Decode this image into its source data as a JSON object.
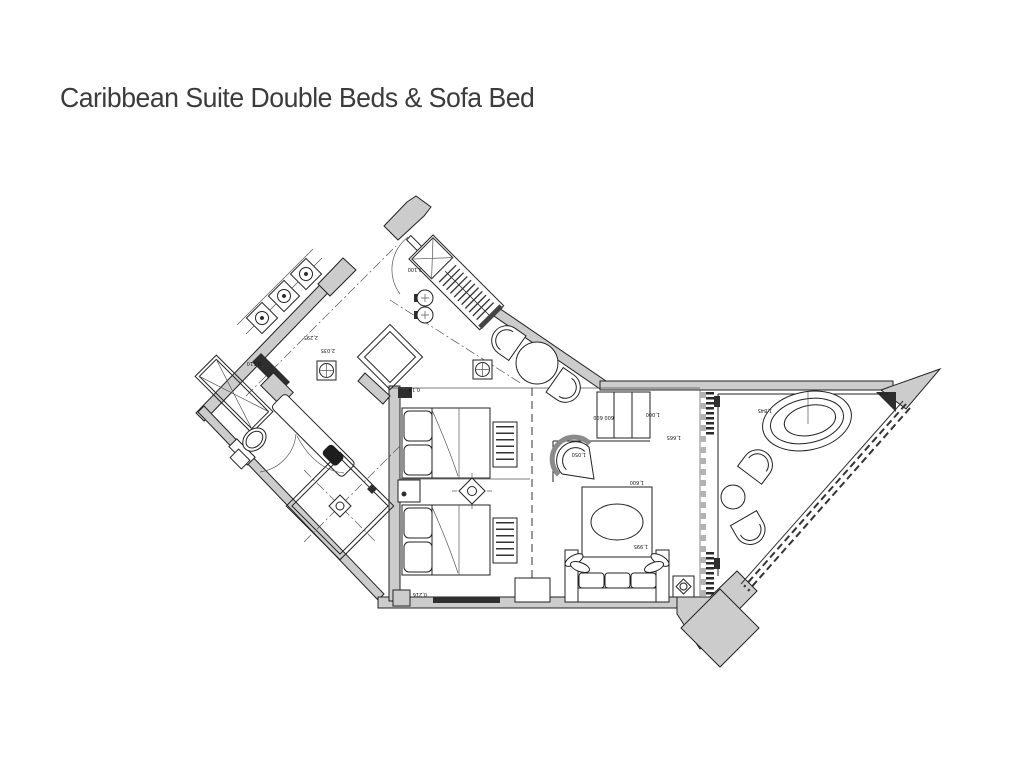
{
  "page": {
    "title": "Caribbean Suite Double Beds & Sofa Bed"
  },
  "colors": {
    "background": "#ffffff",
    "line": "#222222",
    "wall_fill": "#cccccc",
    "wall_dark": "#2e2e2e",
    "title_text": "#3c3c3c",
    "dash_gray": "#b3b3b3",
    "thin": "#555555"
  },
  "plan": {
    "dims": [
      {
        "text": "2,100"
      },
      {
        "text": "2,295"
      },
      {
        "text": "2,035"
      },
      {
        "text": "0,510"
      },
      {
        "text": "0,19"
      },
      {
        "text": "0,216"
      },
      {
        "text": "600 600"
      },
      {
        "text": "1,000"
      },
      {
        "text": "1,665"
      },
      {
        "text": "1,600"
      },
      {
        "text": "1,050"
      },
      {
        "text": "1,845"
      },
      {
        "text": "1,995"
      }
    ],
    "symbols": [
      "ceiling-light-symbol",
      "downlight-symbol",
      "wall-light-symbol",
      "lamp-diamond-symbol"
    ]
  }
}
